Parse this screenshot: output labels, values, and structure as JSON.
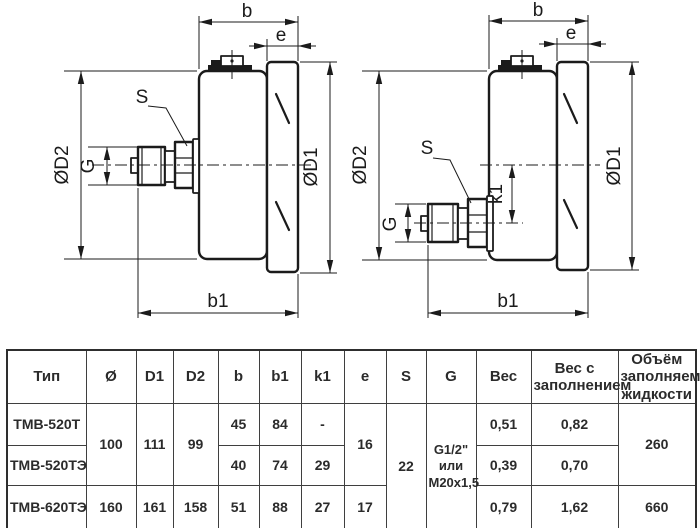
{
  "page": {
    "background": "#ffffff"
  },
  "dim_labels": {
    "b": "b",
    "b1": "b1",
    "e": "e",
    "s": "S",
    "g": "G",
    "k1": "k1",
    "d1": "ØD1",
    "d2": "ØD2"
  },
  "drawings": {
    "left": {
      "description": "side view, axial back connection"
    },
    "right": {
      "description": "side view, eccentric back connection with offset k1"
    }
  },
  "table": {
    "headers": [
      "Тип",
      "Ø",
      "D1",
      "D2",
      "b",
      "b1",
      "k1",
      "e",
      "S",
      "G",
      "Вес",
      "Вес с заполнением",
      "Объём заполняемой жидкости"
    ],
    "rows": {
      "row1": {
        "type": "ТМВ-520Т",
        "b": "45",
        "b1": "84",
        "k1": "-",
        "weight": "0,51",
        "weight_filled": "0,82"
      },
      "row2": {
        "type": "ТМВ-520ТЭ",
        "b": "40",
        "b1": "74",
        "k1": "29",
        "weight": "0,39",
        "weight_filled": "0,70"
      },
      "row3": {
        "type": "ТМВ-620ТЭ",
        "diameter": "160",
        "d1": "161",
        "d2": "158",
        "b": "51",
        "b1": "88",
        "k1": "27",
        "e": "17",
        "weight": "0,79",
        "weight_filled": "1,62",
        "volume": "660"
      },
      "merged": {
        "diameter": "100",
        "d1": "111",
        "d2": "99",
        "e": "16",
        "s": "22",
        "g": "G1/2\"\nили\nM20x1,5",
        "volume": "260"
      }
    }
  }
}
